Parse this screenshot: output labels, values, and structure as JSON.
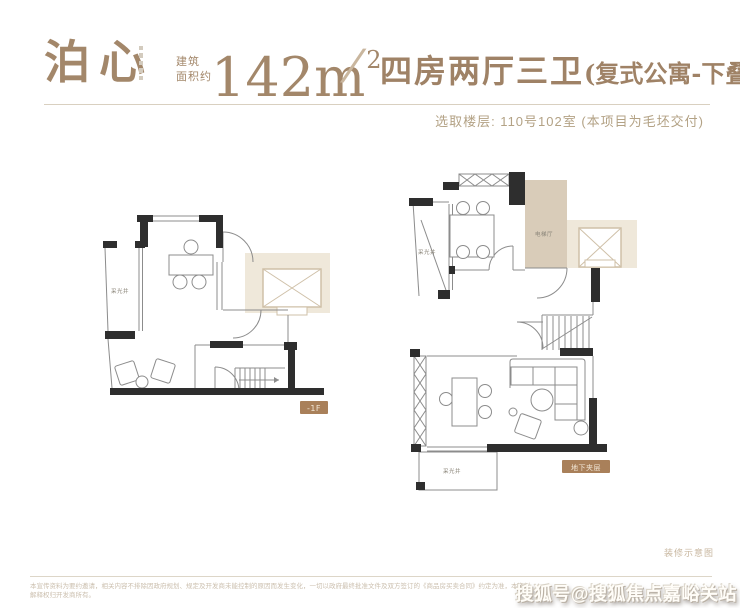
{
  "header": {
    "project_name": "泊心",
    "area_label_line1": "建筑",
    "area_label_line2": "面积约",
    "area_value": "142m",
    "area_exponent": "2",
    "separator": "/",
    "layout_title": "四房两厅三卫",
    "layout_note": "(复式公寓-下叠)",
    "floor_info": "选取楼层: 110号102室 (本项目为毛坯交付)"
  },
  "plan_lower": {
    "light_well": "采光井",
    "badge": "-1F"
  },
  "plan_basement": {
    "light_well_top": "采光井",
    "elevator_hall": "电梯厅",
    "light_well_bottom": "采光井",
    "badge": "地下夹层"
  },
  "footer": {
    "schematic_note": "装修示意图",
    "disclaimer_line1": "本宣传资料为要约邀请，相关内容不排除因政府规划、规定及开发商未能控制的原因而发生变化，一切以政府最终批准文件及双方签订的《商品房买卖合同》约定为准，本资料",
    "disclaimer_line2": "解释权归开发商所有。",
    "watermark": "搜狐号@搜狐焦点嘉峪关站"
  },
  "colors": {
    "brand": "#a3876a",
    "wall": "#2e2e2e",
    "line": "#8c8c8c",
    "beige_fill": "#d9ccb9",
    "beige_light": "#efe8da",
    "badge_bg": "#a9805a"
  }
}
